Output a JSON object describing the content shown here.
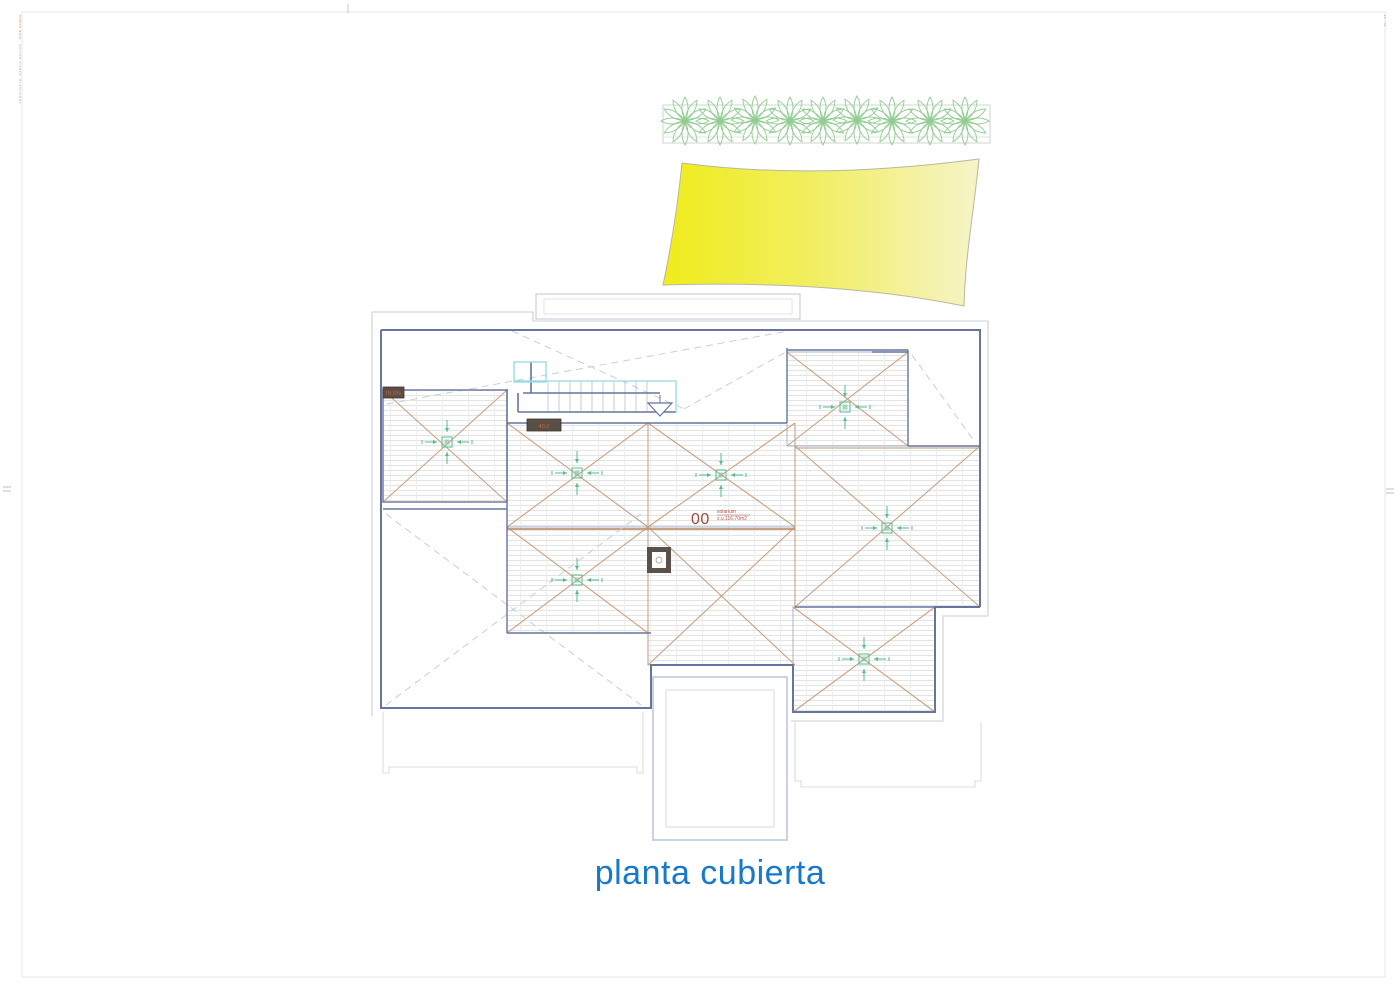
{
  "sheet": {
    "title": "planta cubierta",
    "title_color": "#1879cc",
    "frame_color": "#e4e9e9",
    "background": "#ffffff"
  },
  "edge_text": {
    "left_group_1": "JOSE RAMON",
    "left_group_2": "GARCIA MOLINA",
    "left_group_3": "ARQUITECTO",
    "right_group_1": "PL. 05"
  },
  "plan": {
    "room": {
      "number": "00",
      "name": "solarium",
      "area": "s.u.116.70m2"
    },
    "labels": {
      "slope_a": "IN.5%",
      "slope_b": "40.2"
    },
    "colors": {
      "outline_navy": "#66759e",
      "outline_light": "#c8cfd8",
      "hatch_line": "#dcdcdc",
      "hip_line": "#c9a183",
      "ridge_line": "#bd9472",
      "dashed_line": "#c9ced6",
      "stair_accent_cyan": "#8fdce2",
      "roof_drain_green": "#55bb90",
      "plant_green": "#93cc93",
      "sail_yellow_left": "#f0ec1c",
      "sail_yellow_right": "#f6f4c8",
      "label_box": "#5a4f47",
      "label_text": "#d2622e",
      "room_text": "#9b4a42"
    },
    "features": {
      "planter_plant_count": 9,
      "roof_drain_count": 7,
      "stair_direction": "down"
    }
  }
}
